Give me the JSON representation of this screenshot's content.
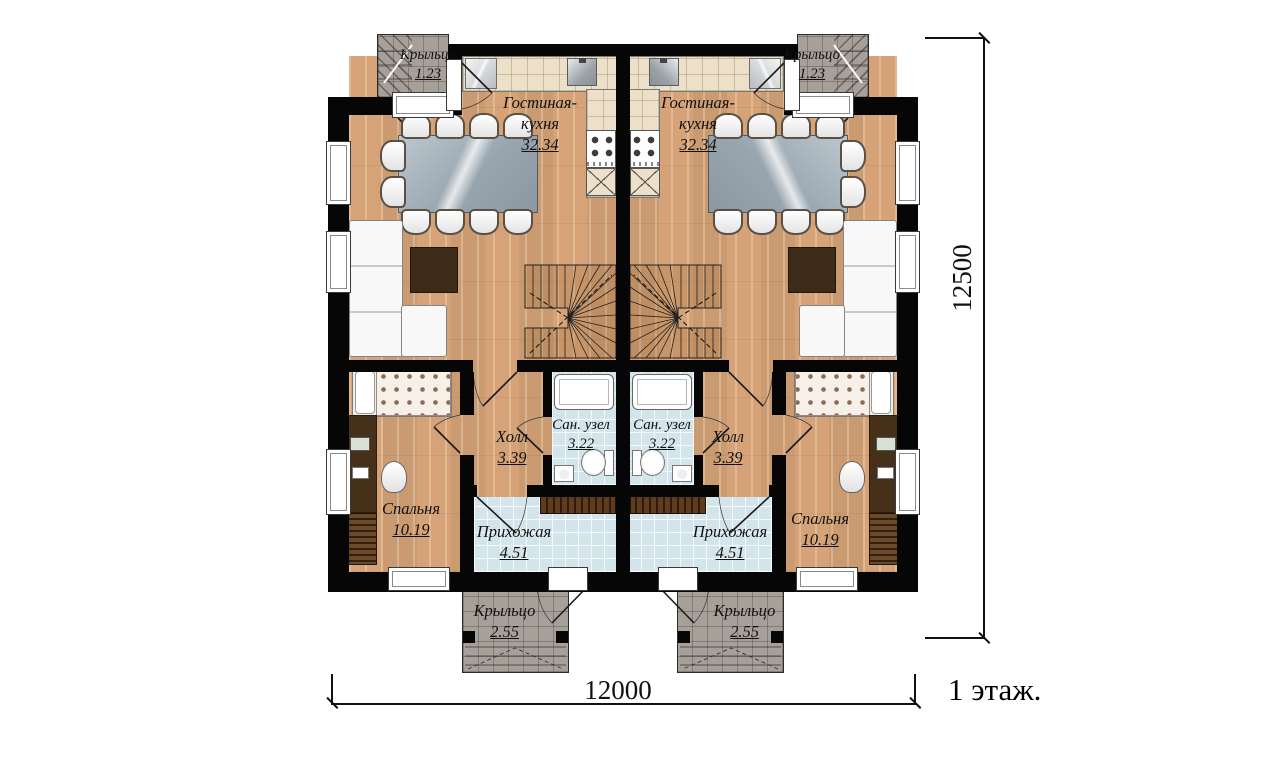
{
  "plan": {
    "floor_title": "1 этаж.",
    "dim_width": "12000",
    "dim_height": "12500"
  },
  "rooms": {
    "porch_top": {
      "name": "Крыльцо",
      "area": "1.23"
    },
    "living_kitchen": {
      "name": "Гостиная-кухня",
      "area": "32.34"
    },
    "hall": {
      "name": "Холл",
      "area": "3.39"
    },
    "bathroom": {
      "name": "Сан. узел",
      "area": "3.22"
    },
    "entry": {
      "name": "Прихожая",
      "area": "4.51"
    },
    "bedroom": {
      "name": "Спальня",
      "area": "10.19"
    },
    "porch_bottom": {
      "name": "Крыльцо",
      "area": "2.55"
    }
  },
  "colors": {
    "wall": "#000000",
    "wood_floor": "#dcab80",
    "tile_blue": "#d3e4eb",
    "tile_beige": "#ece1c8",
    "porch_gray": "#a7a099",
    "furniture_dark": "#46301a"
  }
}
